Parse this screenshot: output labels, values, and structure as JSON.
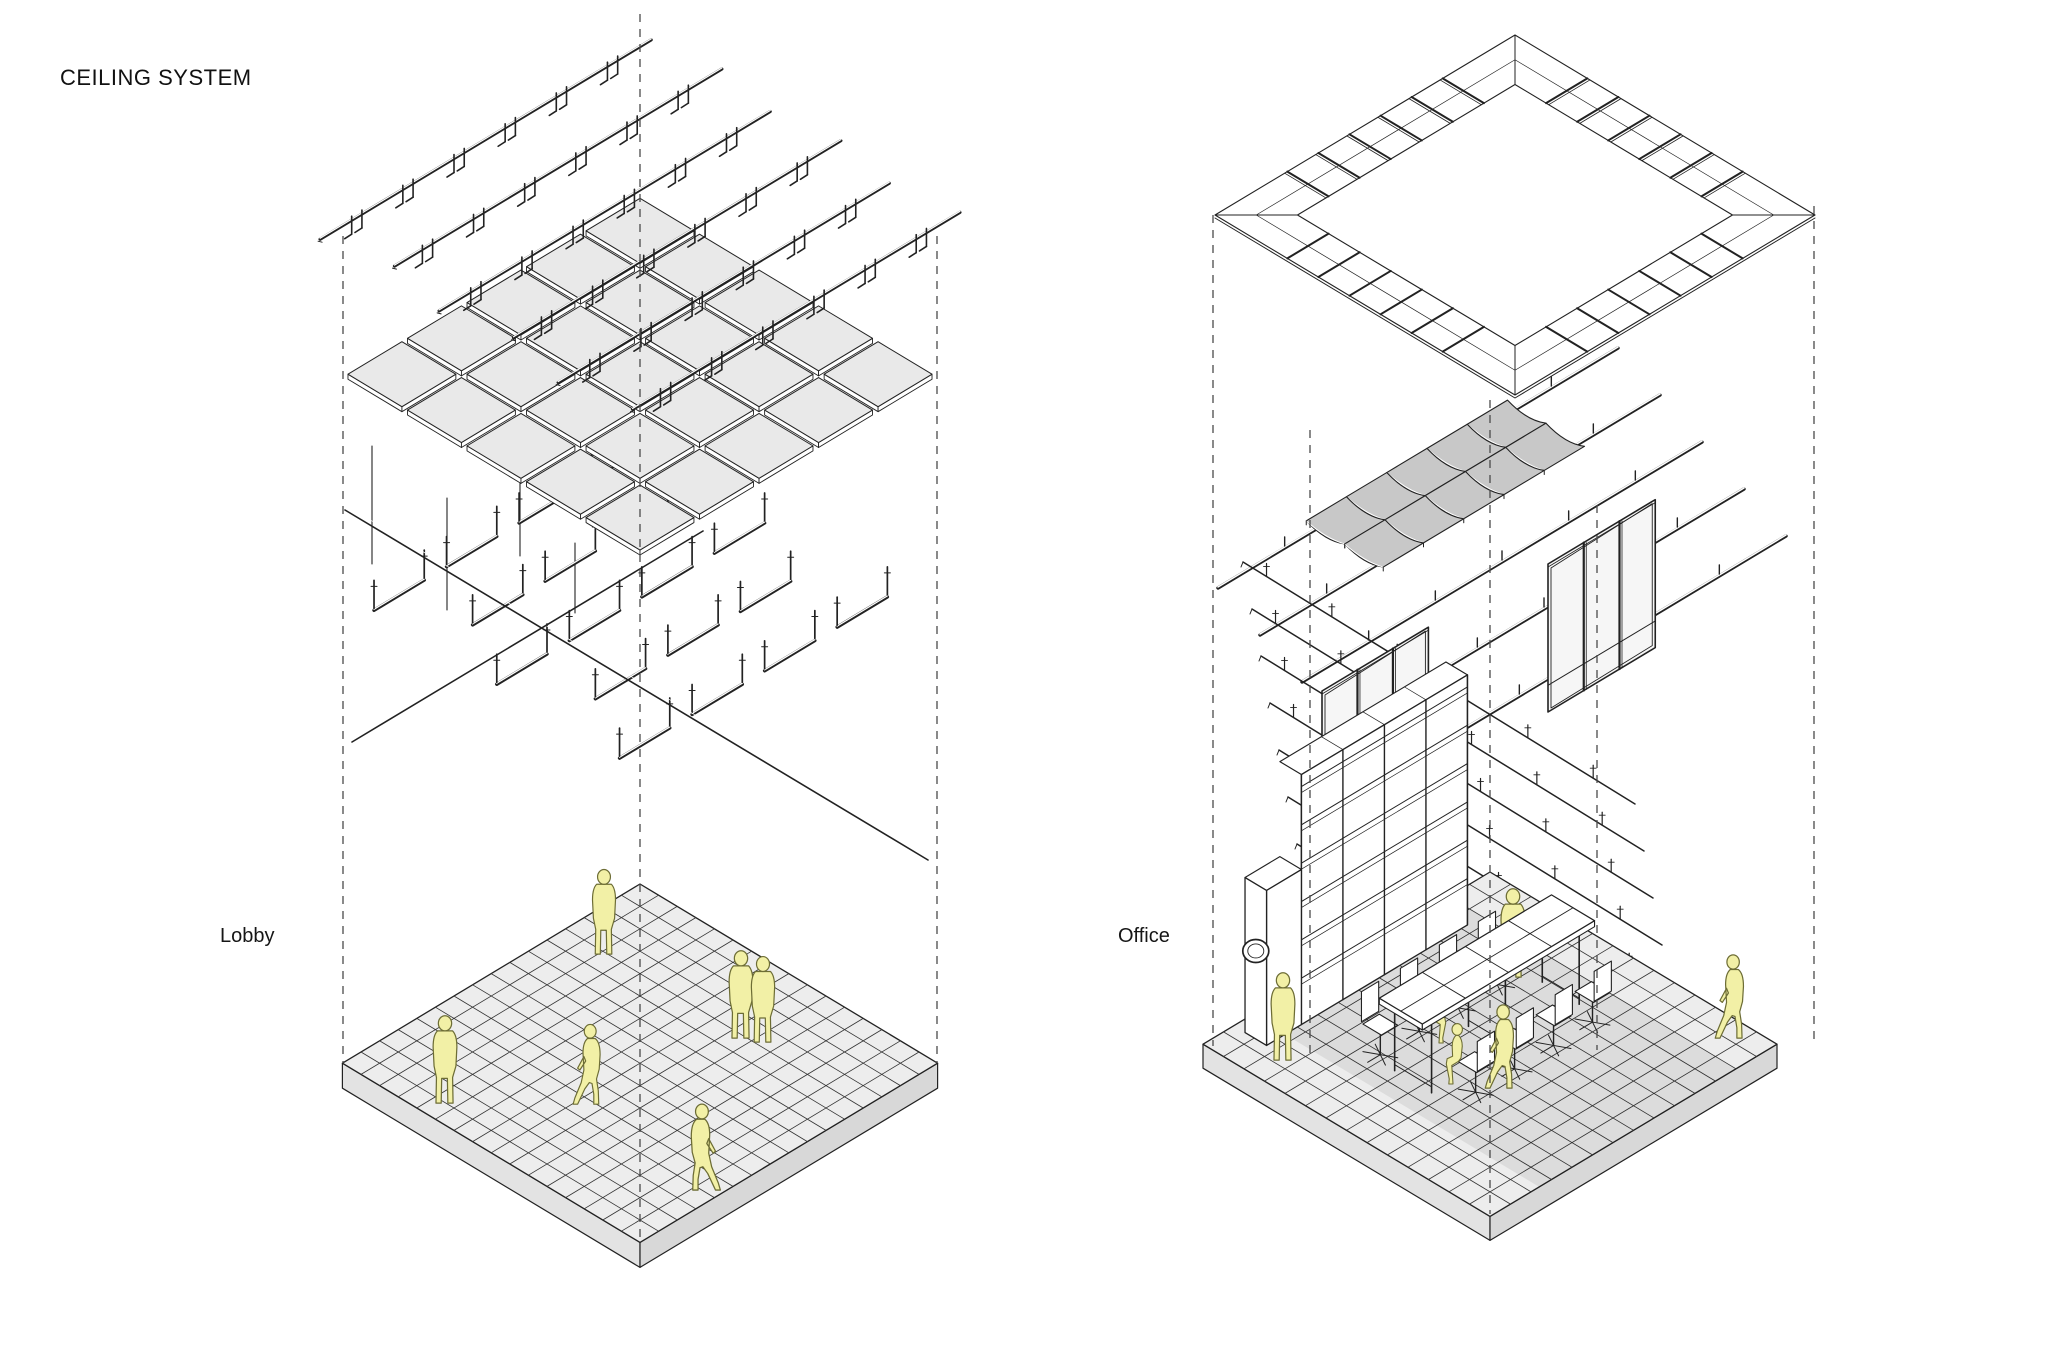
{
  "page": {
    "title": "CEILING SYSTEM"
  },
  "scenes": [
    {
      "id": "lobby",
      "label": "Lobby",
      "people_count": 6,
      "layers": [
        "suspension-rails-with-hanger-clips",
        "square-lay-in-ceiling-tiles",
        "carrier-channels-with-hanger-rods",
        "cross-bracing-rods",
        "tiled-floor-slab",
        "people"
      ]
    },
    {
      "id": "office",
      "label": "Office",
      "people_count": 6,
      "layers": [
        "perimeter-ceiling-tile-ring",
        "curved-acoustic-panels",
        "carrier-rails",
        "cross-runners-with-pins",
        "glazed-partition-frames",
        "shelving-wall-with-clock",
        "desks-with-task-chairs",
        "tiled-floor-slab",
        "people"
      ]
    }
  ],
  "colors": {
    "line": "#222222",
    "grid": "#333333",
    "dash": "#4a4a4a",
    "tile": "#e9e9e9",
    "floorTop": "#ededed",
    "slabLeft": "#e3e3e3",
    "slabRight": "#d8d8d8",
    "panel": "#c8c8c8",
    "glass": "#f6f6f6",
    "shadow": "rgba(0,0,0,0.07)",
    "figure": "#f2f0a6",
    "figureStroke": "#6d6d35",
    "white": "#ffffff"
  }
}
